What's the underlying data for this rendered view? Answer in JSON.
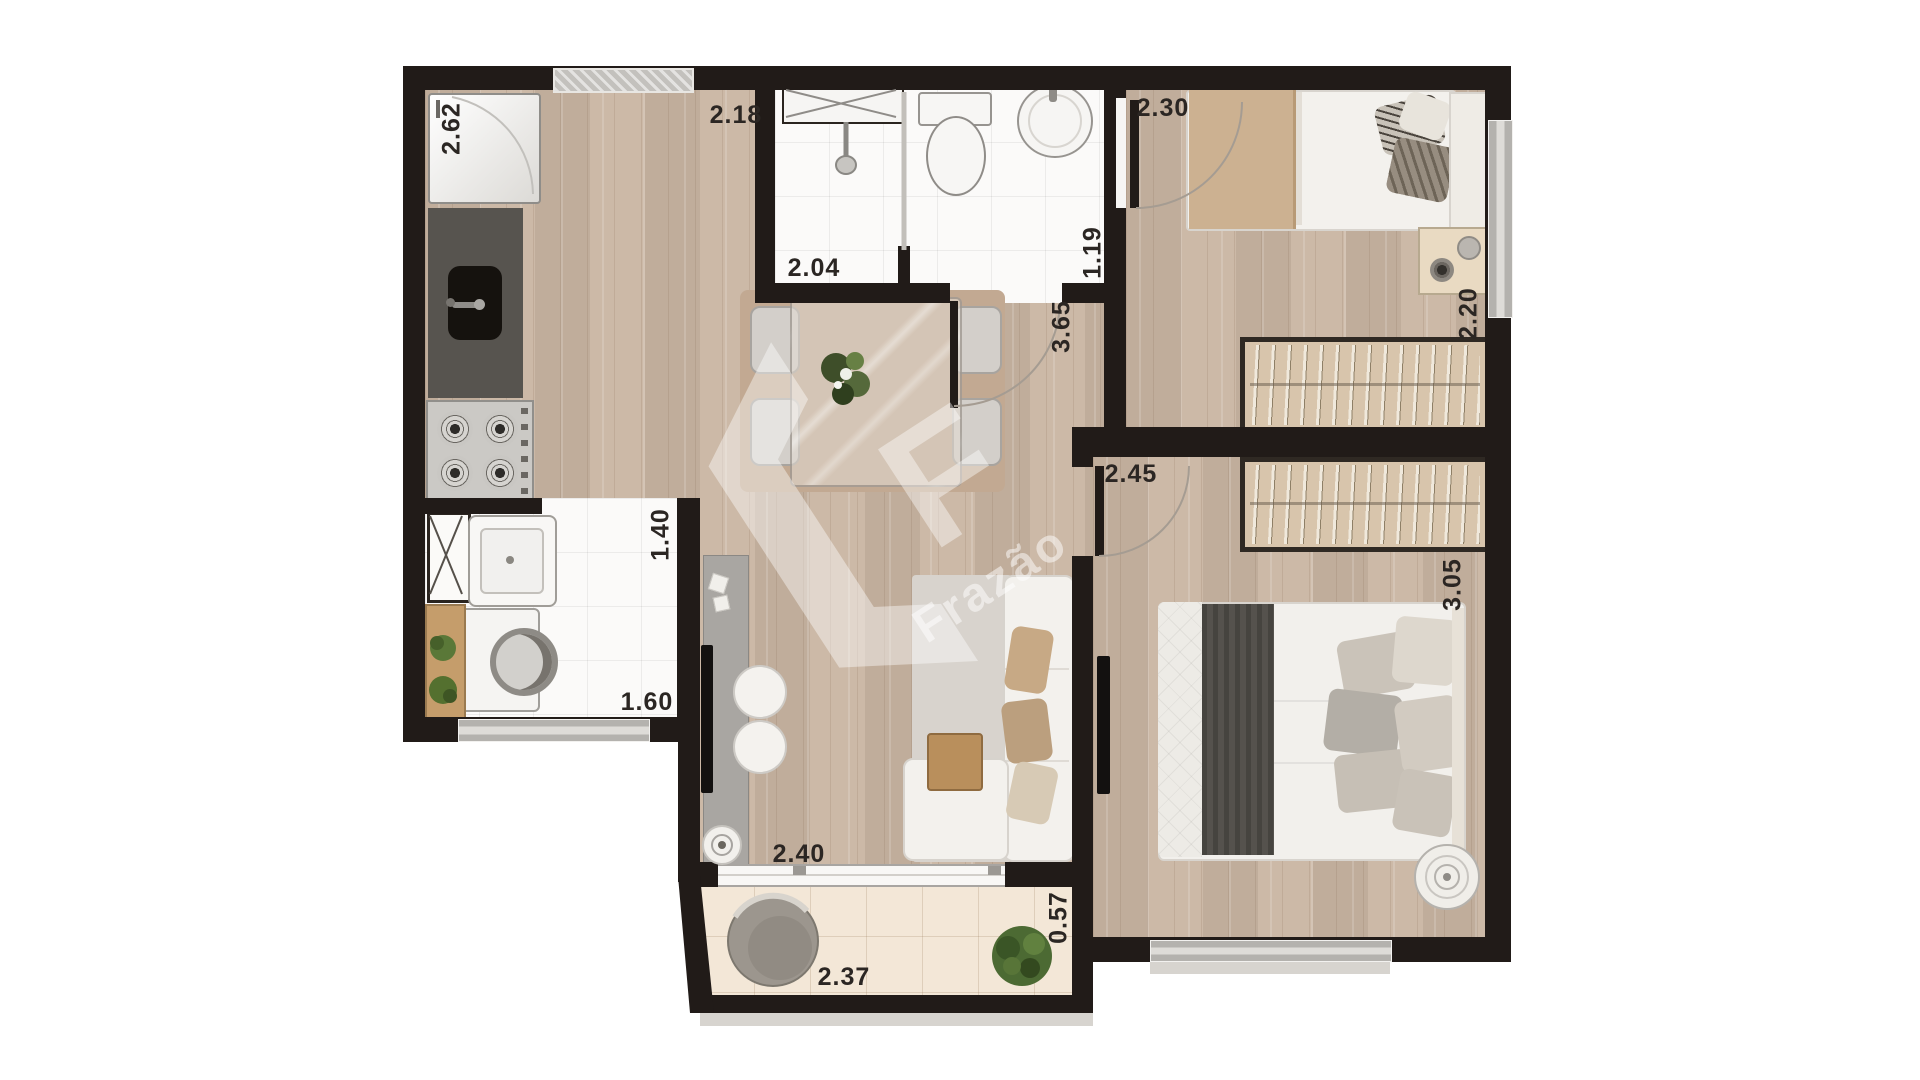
{
  "watermark": {
    "letter": "F",
    "text": "Frazão"
  },
  "dimensions": {
    "refrigerator_wall": "2.62",
    "kitchen_width": "2.18",
    "bathroom_shower_width": "2.04",
    "bathroom_basin_width": "1.19",
    "bedroom1_width": "2.30",
    "bedroom1_depth": "2.20",
    "living_length": "3.65",
    "bedroom2_width": "2.45",
    "bedroom2_depth": "3.05",
    "laundry_depth": "1.40",
    "laundry_width": "1.60",
    "living_width": "2.40",
    "balcony_width": "2.37",
    "balcony_depth": "0.57"
  },
  "colors": {
    "wall": "#211b18",
    "wood_floor": "#c9b5a2",
    "tile_floor": "#fbfaf9",
    "balcony_floor": "#f3e7d7",
    "wardrobe": "#d8c5ac",
    "label_text": "#2b2623"
  }
}
